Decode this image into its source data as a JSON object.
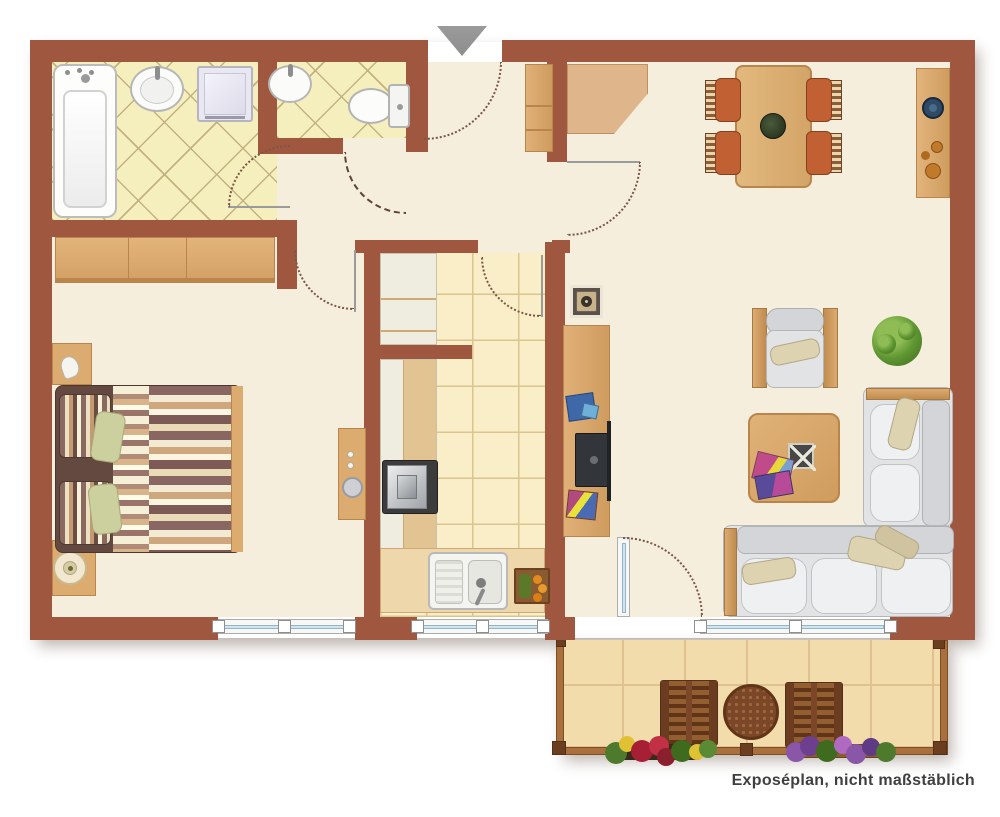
{
  "caption": "Exposéplan, nicht maßstäblich",
  "entrance": {
    "marker": "entrance-arrow-down"
  },
  "colors": {
    "background": "#ffffff",
    "wall": "#a0573f",
    "floor": "#f5eedd",
    "bath_tile": "#f5efbe",
    "bath_tile_line": "#c3b27f",
    "kitchen_tile": "#f9eec7",
    "kitchen_tile_line": "#dcc48e",
    "balcony_tile": "#f3dcab",
    "balcony_tile_line": "#e0c18f",
    "wood": "#dcab70",
    "wood_dark": "#b9854c",
    "closet_wood": "#dfb68c",
    "upholstery": "#e2e3e5",
    "cushion": "#ded3b1",
    "chair_seat": "#c06033",
    "outdoor_wood": "#7b4728",
    "window_glass": "#cfe4ee",
    "door_arc": "#7a5645",
    "arrow": "#8d8d8d",
    "caption_text": "#3f3f3f"
  },
  "icons": [
    "entrance-arrow",
    "bathtub",
    "washbasin",
    "shower-cabinet",
    "toilet",
    "wardrobe",
    "hall-wardrobe",
    "corner-closet",
    "double-bed",
    "pillow",
    "nightstand",
    "table-lamp",
    "dressing-table",
    "kitchen-upper-cabinet",
    "kitchen-counter",
    "stove",
    "kitchen-sink",
    "produce-crate",
    "dining-table",
    "dining-chair",
    "sideboard",
    "speaker",
    "tv-lowboard",
    "tv",
    "armchair",
    "potted-plant",
    "coffee-table",
    "magazines",
    "corner-sofa",
    "balcony-table",
    "balcony-chair",
    "flower-box",
    "window",
    "door-swing"
  ]
}
